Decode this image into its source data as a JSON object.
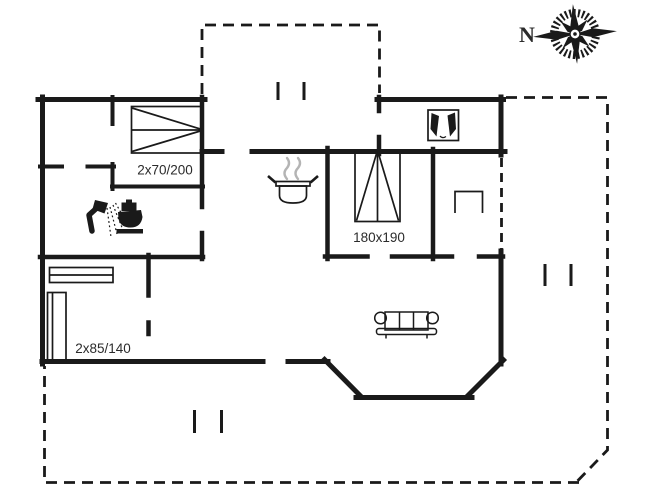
{
  "plan": {
    "type": "holiday-house floor plan",
    "labels": {
      "bed_double_small": "2x70/200",
      "bed_double": "180x190",
      "bed_bunk": "2x85/140",
      "compass_north": "N"
    },
    "icons": [
      "compass-rose-icon",
      "double-bed-icon",
      "double-bed-180x190-icon",
      "bunk-bed-icon",
      "closet-icon",
      "shower-icon",
      "toilet-icon",
      "cooking-pot-icon",
      "wardrobe-icon",
      "sofa-icon",
      "stove-niche-icon",
      "terrace-step-marks"
    ],
    "colors": {
      "wall": "#1a1a1a",
      "steam": "#b4b4b4",
      "text": "#2b2b2b",
      "background": "#ffffff"
    }
  }
}
